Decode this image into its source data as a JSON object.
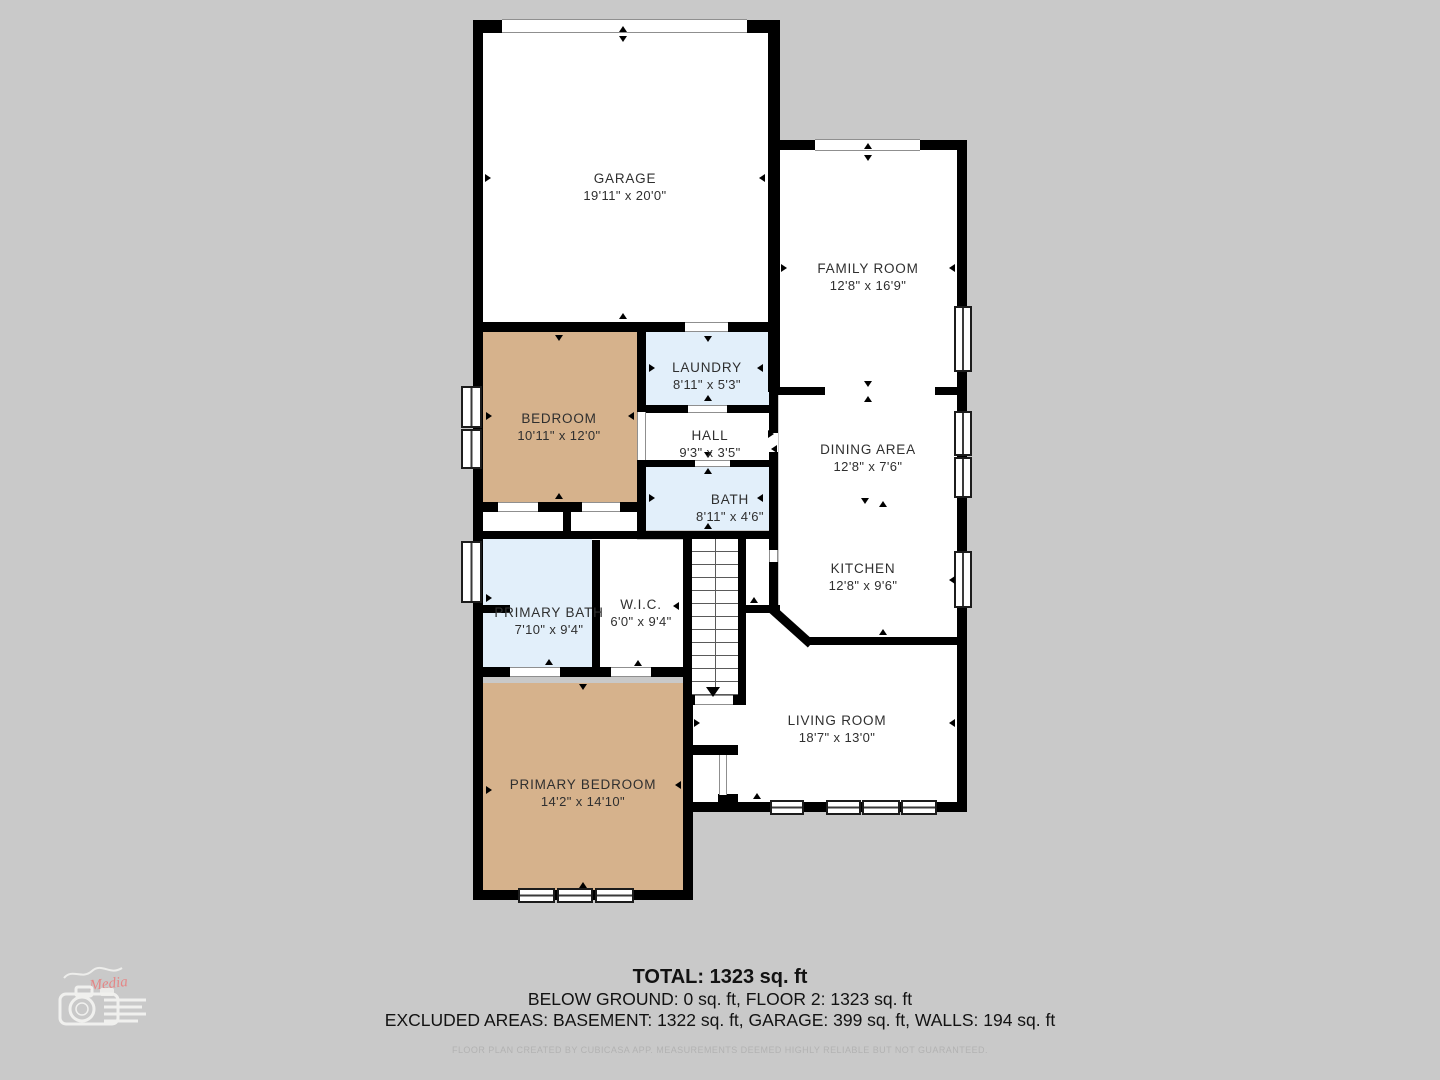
{
  "plan": {
    "rooms": [
      {
        "id": "garage",
        "name": "GARAGE",
        "dims": "19'11\" x 20'0\""
      },
      {
        "id": "family-room",
        "name": "FAMILY ROOM",
        "dims": "12'8\" x 16'9\""
      },
      {
        "id": "laundry",
        "name": "LAUNDRY",
        "dims": "8'11\" x 5'3\""
      },
      {
        "id": "bedroom",
        "name": "BEDROOM",
        "dims": "10'11\" x 12'0\""
      },
      {
        "id": "hall",
        "name": "HALL",
        "dims": "9'3\" x 3'5\""
      },
      {
        "id": "dining-area",
        "name": "DINING AREA",
        "dims": "12'8\" x 7'6\""
      },
      {
        "id": "bath",
        "name": "BATH",
        "dims": "8'11\" x 4'6\""
      },
      {
        "id": "kitchen",
        "name": "KITCHEN",
        "dims": "12'8\" x 9'6\""
      },
      {
        "id": "primary-bath",
        "name": "PRIMARY BATH",
        "dims": "7'10\" x 9'4\""
      },
      {
        "id": "wic",
        "name": "W.I.C.",
        "dims": "6'0\" x 9'4\""
      },
      {
        "id": "living-room",
        "name": "LIVING ROOM",
        "dims": "18'7\" x 13'0\""
      },
      {
        "id": "primary-bedroom",
        "name": "PRIMARY BEDROOM",
        "dims": "14'2\" x 14'10\""
      }
    ]
  },
  "footer": {
    "total": "TOTAL: 1323 sq. ft",
    "line2": "BELOW GROUND: 0 sq. ft, FLOOR 2: 1323 sq. ft",
    "line3": "EXCLUDED AREAS: BASEMENT: 1322 sq. ft, GARAGE: 399 sq. ft, WALLS: 194 sq. ft",
    "disclaimer": "FLOOR PLAN CREATED BY CUBICASA APP. MEASUREMENTS DEEMED HIGHLY RELIABLE BUT NOT GUARANTEED."
  },
  "watermark": {
    "media_label": "Media"
  },
  "colors": {
    "background": "#C9C9C9",
    "walls": "#000000",
    "bedroom_fill": "#D6B28C",
    "wet_room_fill": "#E2EFFA",
    "floor_fill": "#FFFFFF",
    "logo_red": "#E88080",
    "disclaimer_gray": "#B2B2B2"
  }
}
